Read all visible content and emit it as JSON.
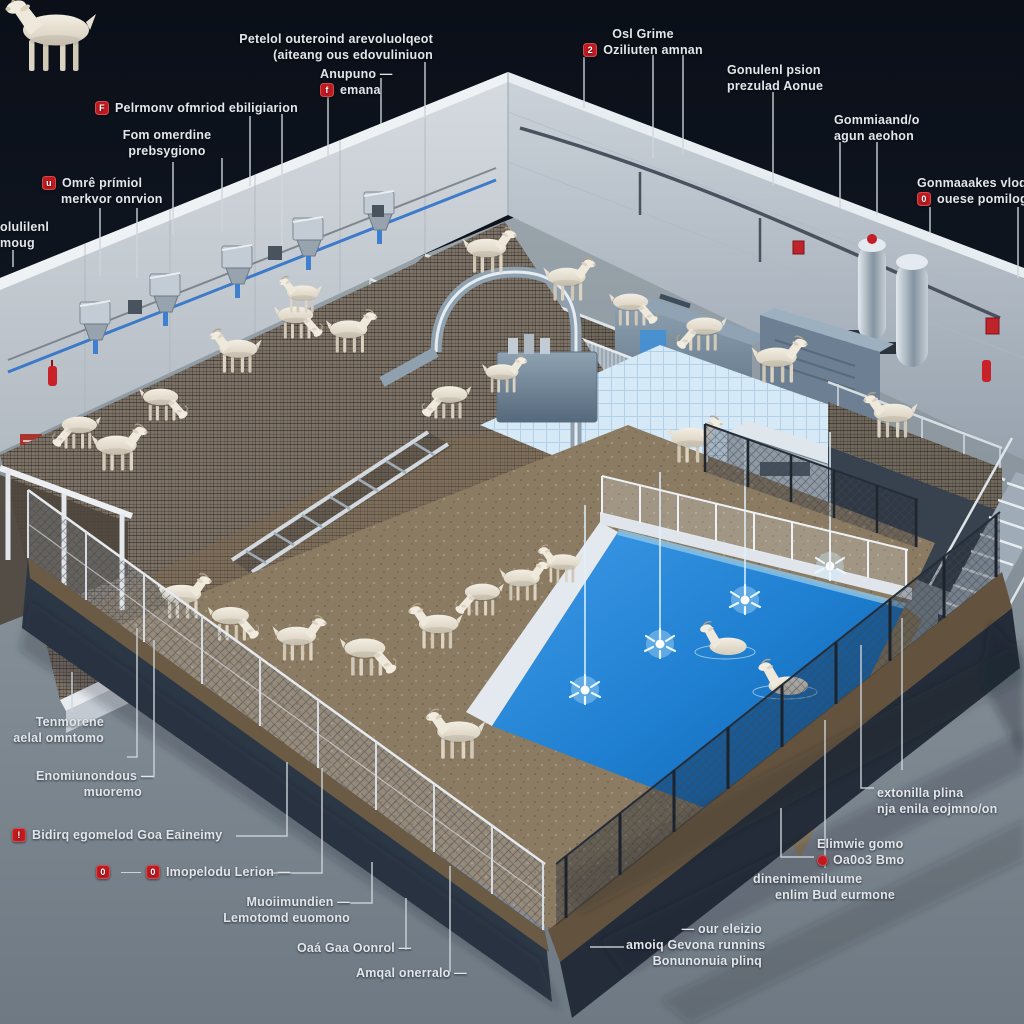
{
  "scene": {
    "subject": "Isometric 3D cutaway illustration of an automated goat farming facility",
    "goats_visible": 27,
    "features": [
      "wall-mounted feeder units with blue pipes",
      "mesh walkway ramp with goats",
      "stainless machine room",
      "dirt exercise pens",
      "fountain pool with goats standing in water",
      "chain-link fencing",
      "staircase",
      "mezzanine platform",
      "fire alarm boxes and extinguishers"
    ]
  },
  "colors": {
    "background_top": "#0a0f18",
    "ground": "#818c95",
    "wall": "#c7cdd3",
    "water": "#1f7fd0",
    "marker_red": "#bf1a20",
    "label_text": "#e2e6ea",
    "leader_line": "#cfd6dc"
  },
  "callouts": [
    {
      "name": "top-center-note",
      "lines": [
        "Petelol outeroind  arevoluolqeot",
        "(aiteang ous edovuliniuon"
      ]
    },
    {
      "name": "anupuno",
      "icon": "f",
      "lines": [
        "Anupuno —",
        "emana"
      ]
    },
    {
      "name": "pelrmonv",
      "icon": "F",
      "lines": [
        "Pelrmonv ofmriod ebiligiarion"
      ]
    },
    {
      "name": "fom-omerdine",
      "lines": [
        "Fom omerdine",
        "prebsygiono"
      ]
    },
    {
      "name": "omre-primiol",
      "icon": "u",
      "lines": [
        "Omrê prímiol",
        "merkvor onrvion"
      ]
    },
    {
      "name": "olulilenl",
      "lines": [
        "olulilenl",
        "moug"
      ]
    },
    {
      "name": "osl-grime",
      "icon": "2",
      "lines": [
        "Osl Grime",
        "Oziliuten amnan"
      ]
    },
    {
      "name": "gonulenl",
      "lines": [
        "Gonulenl psion",
        "prezulad Aonue"
      ]
    },
    {
      "name": "gommiaand",
      "lines": [
        "Gommiaand/o",
        "agun aeohon"
      ]
    },
    {
      "name": "gonmaaakes",
      "icon": "0",
      "lines": [
        "Gonmaaakes vlodilu",
        "ouese pomilog"
      ]
    },
    {
      "name": "tenmorene",
      "lines": [
        "Tenmorene",
        "aelal omntomo"
      ]
    },
    {
      "name": "enomiunondous",
      "lines": [
        "Enomiunondous —",
        "muoremo"
      ]
    },
    {
      "name": "bidirq",
      "icon": "!",
      "lines": [
        "Bidirq egomelod Goa Eaineimy"
      ]
    },
    {
      "name": "imopelodu",
      "icon": "0",
      "icon2": "0",
      "lines": [
        "Imopelodu Lerion —"
      ]
    },
    {
      "name": "muoiimundien",
      "lines": [
        "Muoiimundien —",
        "Lemotomd euomono"
      ]
    },
    {
      "name": "oaa-gaa-oonrol",
      "lines": [
        "Oaá Gaa Oonrol —"
      ]
    },
    {
      "name": "amqal",
      "lines": [
        "Amqal onerralo —"
      ]
    },
    {
      "name": "extonilla",
      "lines": [
        "extonilla plina",
        "nja enila eojmno/on"
      ]
    },
    {
      "name": "elimwie",
      "icon": "",
      "lines": [
        "Elimwie gomo",
        "Oa0o3 Bmo"
      ]
    },
    {
      "name": "dinenim",
      "lines": [
        "dinenimemiluume",
        "enlim Bud eurmone"
      ]
    },
    {
      "name": "our-eleizio",
      "lines": [
        "— our eleizio",
        "amoiq Gevona runnins",
        "Bonunonuia plinq"
      ]
    }
  ]
}
